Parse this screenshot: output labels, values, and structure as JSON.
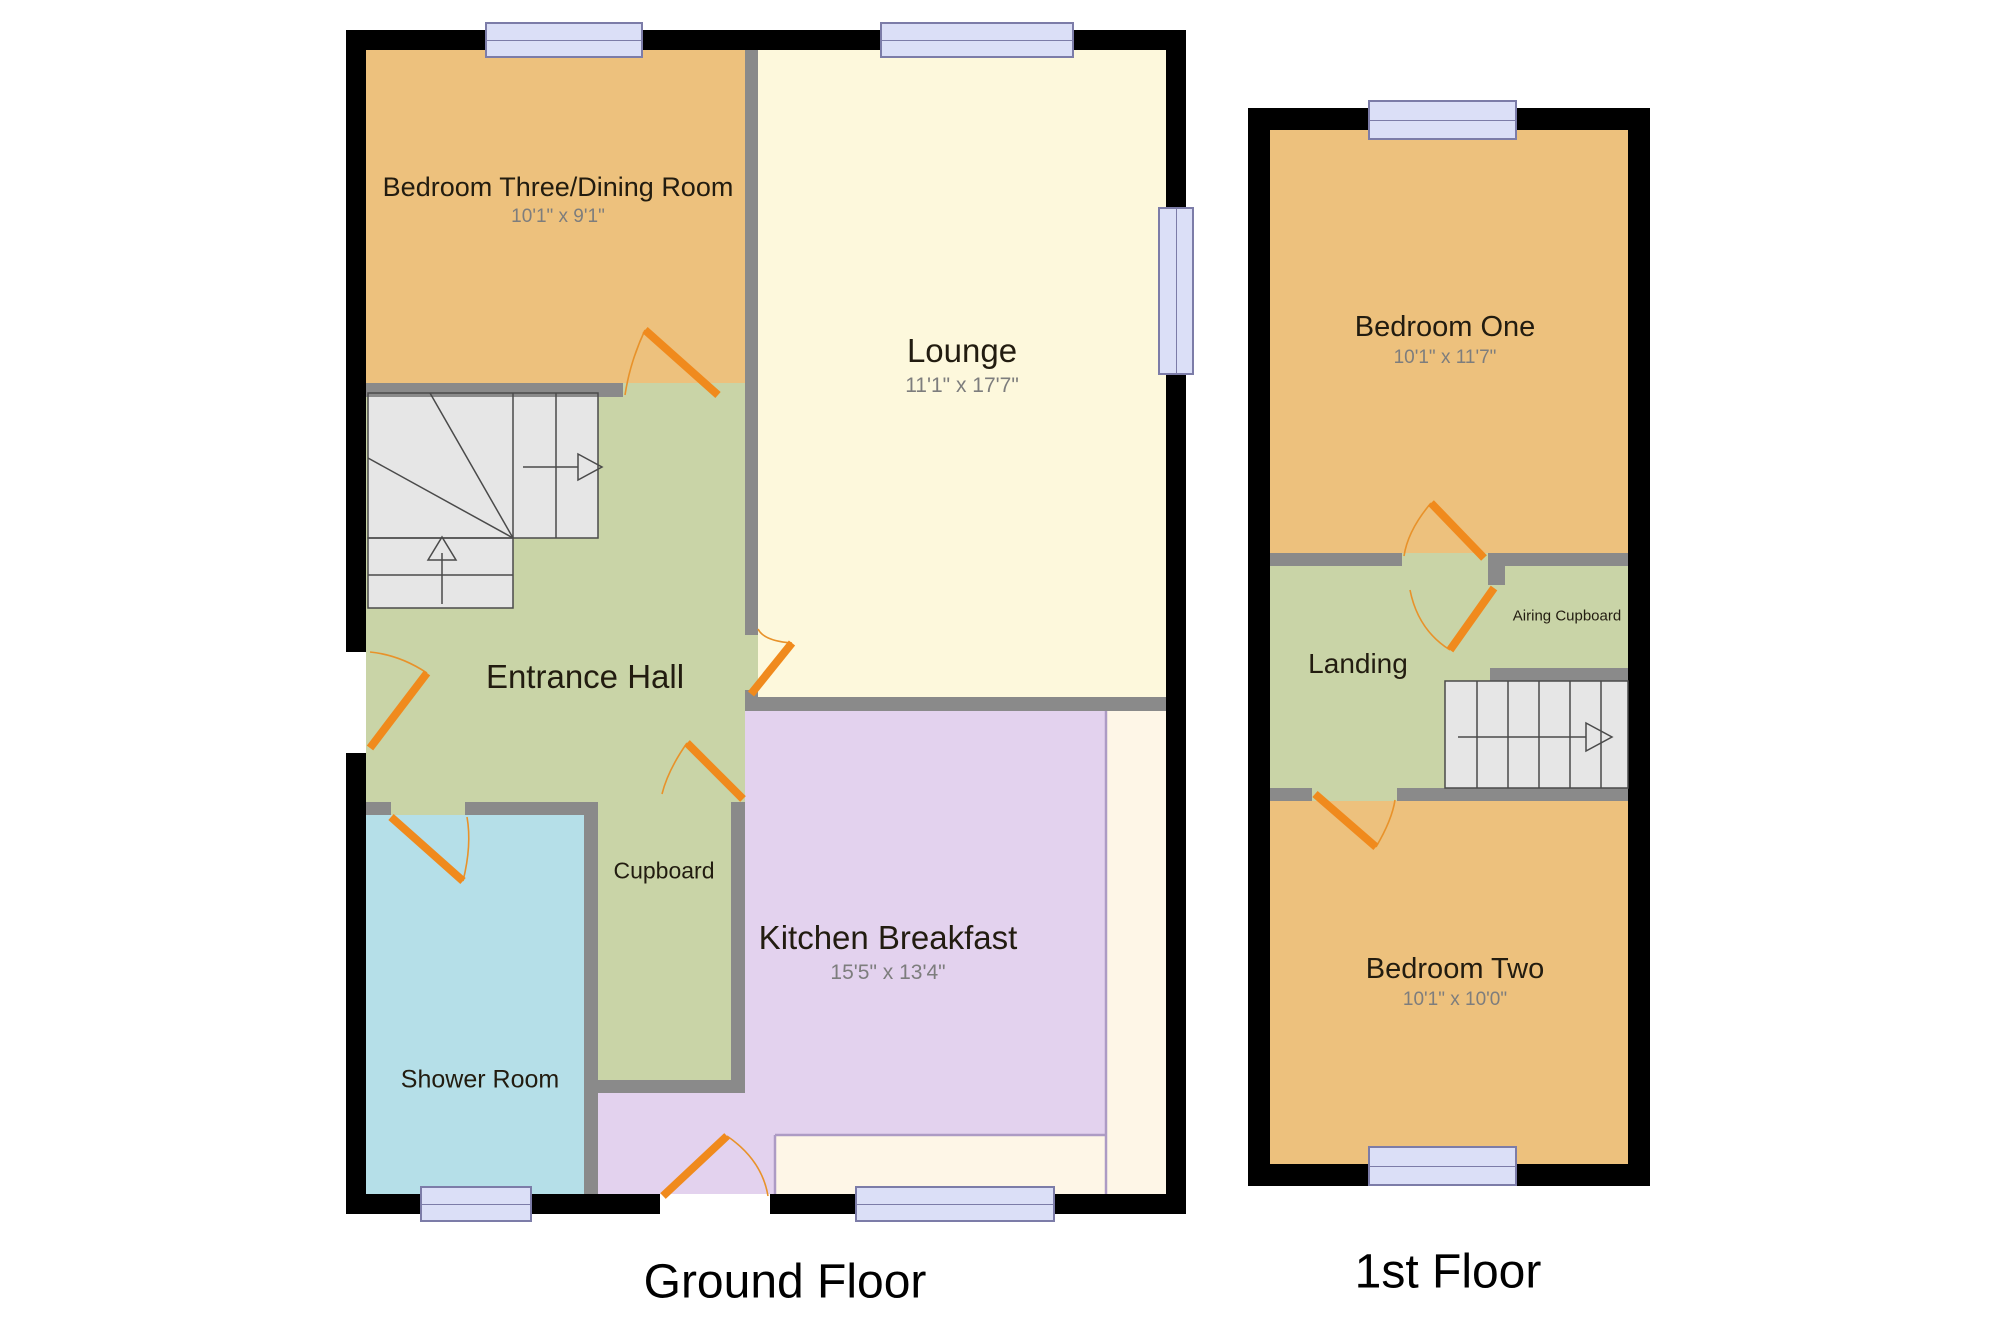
{
  "floors": {
    "ground": {
      "title": "Ground Floor",
      "rooms": {
        "bedroom_three": {
          "name": "Bedroom Three/Dining Room",
          "dims": "10'1\" x 9'1\""
        },
        "lounge": {
          "name": "Lounge",
          "dims": "11'1\" x 17'7\""
        },
        "entrance_hall": {
          "name": "Entrance Hall"
        },
        "cupboard": {
          "name": "Cupboard"
        },
        "shower_room": {
          "name": "Shower Room"
        },
        "kitchen": {
          "name": "Kitchen Breakfast",
          "dims": "15'5\" x 13'4\""
        }
      }
    },
    "first": {
      "title": "1st Floor",
      "rooms": {
        "bedroom_one": {
          "name": "Bedroom One",
          "dims": "10'1\" x 11'7\""
        },
        "landing": {
          "name": "Landing"
        },
        "airing_cupboard": {
          "name": "Airing Cupboard"
        },
        "bedroom_two": {
          "name": "Bedroom Two",
          "dims": "10'1\" x 10'0\""
        }
      }
    }
  },
  "colors": {
    "bedroom_orange": "#edc17d",
    "lounge_cream": "#fdf8dc",
    "hall_green": "#c9d4a7",
    "kitchen_lilac": "#e3d2ee",
    "shower_blue": "#b5dfe8",
    "recess_cream": "#fef6e7",
    "exterior_wall": "#000000",
    "interior_wall": "#8a8a8a",
    "door_orange": "#f08a1d",
    "window_fill": "#dbdff7",
    "stair_gray": "#e6e6e6"
  }
}
